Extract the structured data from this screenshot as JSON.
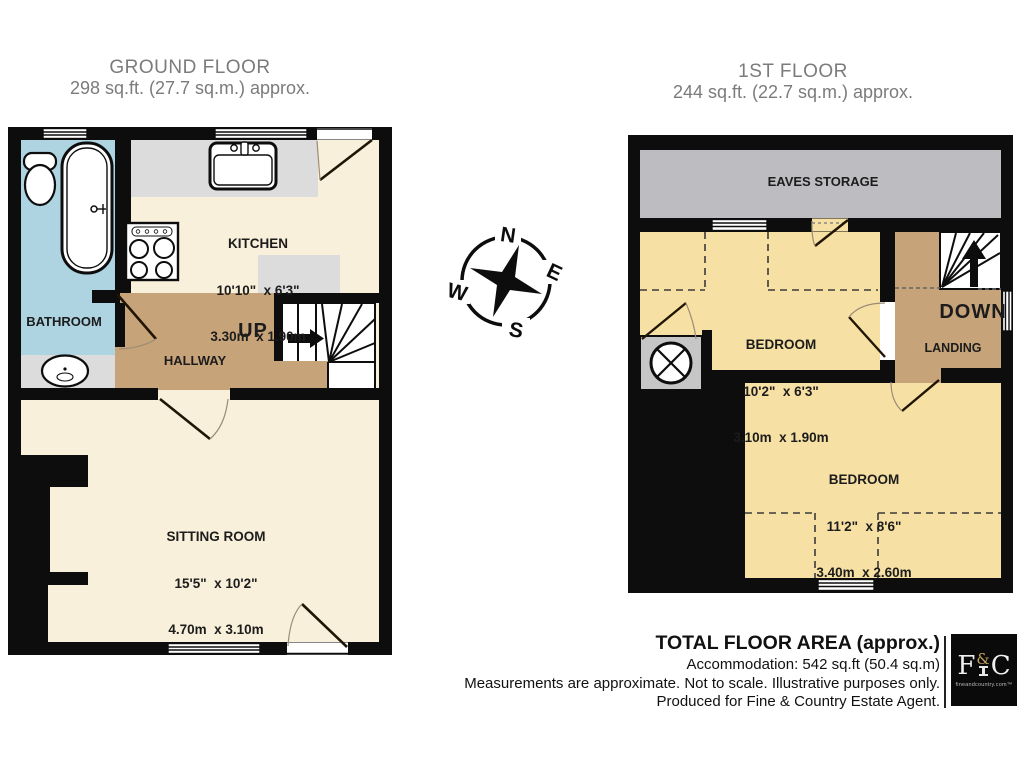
{
  "ground_floor": {
    "title": "GROUND FLOOR",
    "subtitle": "298 sq.ft. (27.7 sq.m.) approx.",
    "stairs_direction": "UP",
    "rooms": {
      "bathroom": {
        "name": "BATHROOM"
      },
      "kitchen": {
        "name": "KITCHEN",
        "size_imperial": "10'10\"  x 6'3\"",
        "size_metric": "3.30m  x 1.90m"
      },
      "hallway": {
        "name": "HALLWAY"
      },
      "sitting_room": {
        "name": "SITTING ROOM",
        "size_imperial": "15'5\"  x 10'2\"",
        "size_metric": "4.70m  x 3.10m"
      }
    }
  },
  "first_floor": {
    "title": "1ST FLOOR",
    "subtitle": "244 sq.ft. (22.7 sq.m.) approx.",
    "stairs_direction": "DOWN",
    "rooms": {
      "eaves_storage": {
        "name": "EAVES STORAGE"
      },
      "bedroom_front": {
        "name": "BEDROOM",
        "size_imperial": "10'2\"  x 6'3\"",
        "size_metric": "3.10m  x 1.90m"
      },
      "landing": {
        "name": "LANDING"
      },
      "bedroom_main": {
        "name": "BEDROOM",
        "size_imperial": "11'2\"  x 8'6\"",
        "size_metric": "3.40m  x 2.60m"
      }
    }
  },
  "compass": {
    "n": "N",
    "e": "E",
    "s": "S",
    "w": "W"
  },
  "footer": {
    "title": "TOTAL FLOOR AREA (approx.)",
    "accommodation": "Accommodation: 542 sq.ft (50.4 sq.m)",
    "disclaimer": "Measurements are approximate. Not to scale. Illustrative purposes only.",
    "producer": "Produced for Fine & Country Estate Agent.",
    "logo": {
      "letter_f": "F",
      "ampersand": "&",
      "letter_c": "C",
      "domain": "fineandcountry.com™"
    }
  },
  "colors": {
    "wall": "#0d0d0d",
    "ground_floor_room": "#f8f0da",
    "first_floor_room": "#f6e0a3",
    "hallway_landing": "#c7a379",
    "bathroom": "#aed4e2",
    "eaves_storage": "#bdbdc1",
    "counter": "#dcdcdc",
    "title_text": "#7b7b7b",
    "label_text": "#1c1c1c"
  }
}
